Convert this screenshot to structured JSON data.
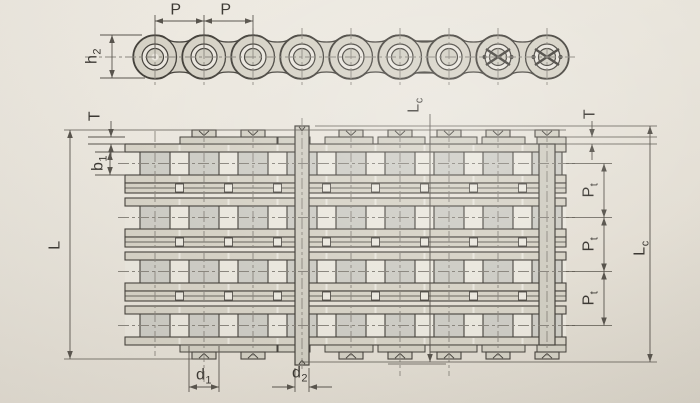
{
  "colors": {
    "paper": "#e8e4db",
    "paper_light": "#eae7de",
    "line": "#45423c",
    "dim_line": "#58544d",
    "centerline": "#8a867e",
    "plate": "#d6d2c6",
    "roller": "#cdccc5",
    "fitting": "#d2cfc3",
    "pin": "#d0cdc2",
    "bush": "#eae6de",
    "text": "#3b3833"
  },
  "side_view": {
    "labels": {
      "p1": {
        "main": "P",
        "sub": ""
      },
      "p2": {
        "main": "P",
        "sub": ""
      },
      "h2": {
        "main": "h",
        "sub": "2"
      }
    }
  },
  "plan_view": {
    "labels": {
      "t_left": {
        "main": "T",
        "sub": ""
      },
      "b1": {
        "main": "b",
        "sub": "1"
      },
      "l": {
        "main": "L",
        "sub": ""
      },
      "lc_top": {
        "main": "L",
        "sub": "c"
      },
      "t_right": {
        "main": "T",
        "sub": ""
      },
      "pt1": {
        "main": "P",
        "sub": "t"
      },
      "pt2": {
        "main": "P",
        "sub": "t"
      },
      "pt3": {
        "main": "P",
        "sub": "t"
      },
      "lc_right": {
        "main": "L",
        "sub": "c"
      },
      "d1": {
        "main": "d",
        "sub": "1"
      },
      "d2": {
        "main": "d",
        "sub": "2"
      }
    }
  }
}
